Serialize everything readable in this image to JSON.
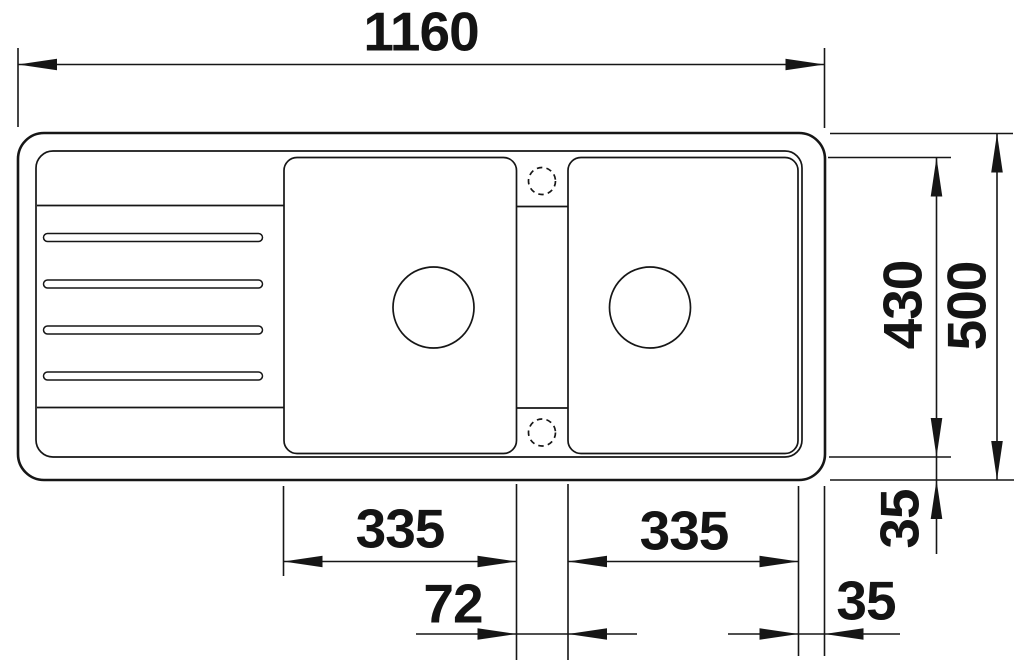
{
  "drawing": {
    "type": "sink-technical-drawing-top-view",
    "line_color": "#161616",
    "background": "#ffffff",
    "labels": {
      "total_width": "1160",
      "inner_depth": "430",
      "total_depth": "500",
      "left_bowl_width": "335",
      "right_bowl_width": "335",
      "bowl_gap": "72",
      "bottom_rim_offset": "35",
      "right_rim_offset": "35"
    }
  }
}
